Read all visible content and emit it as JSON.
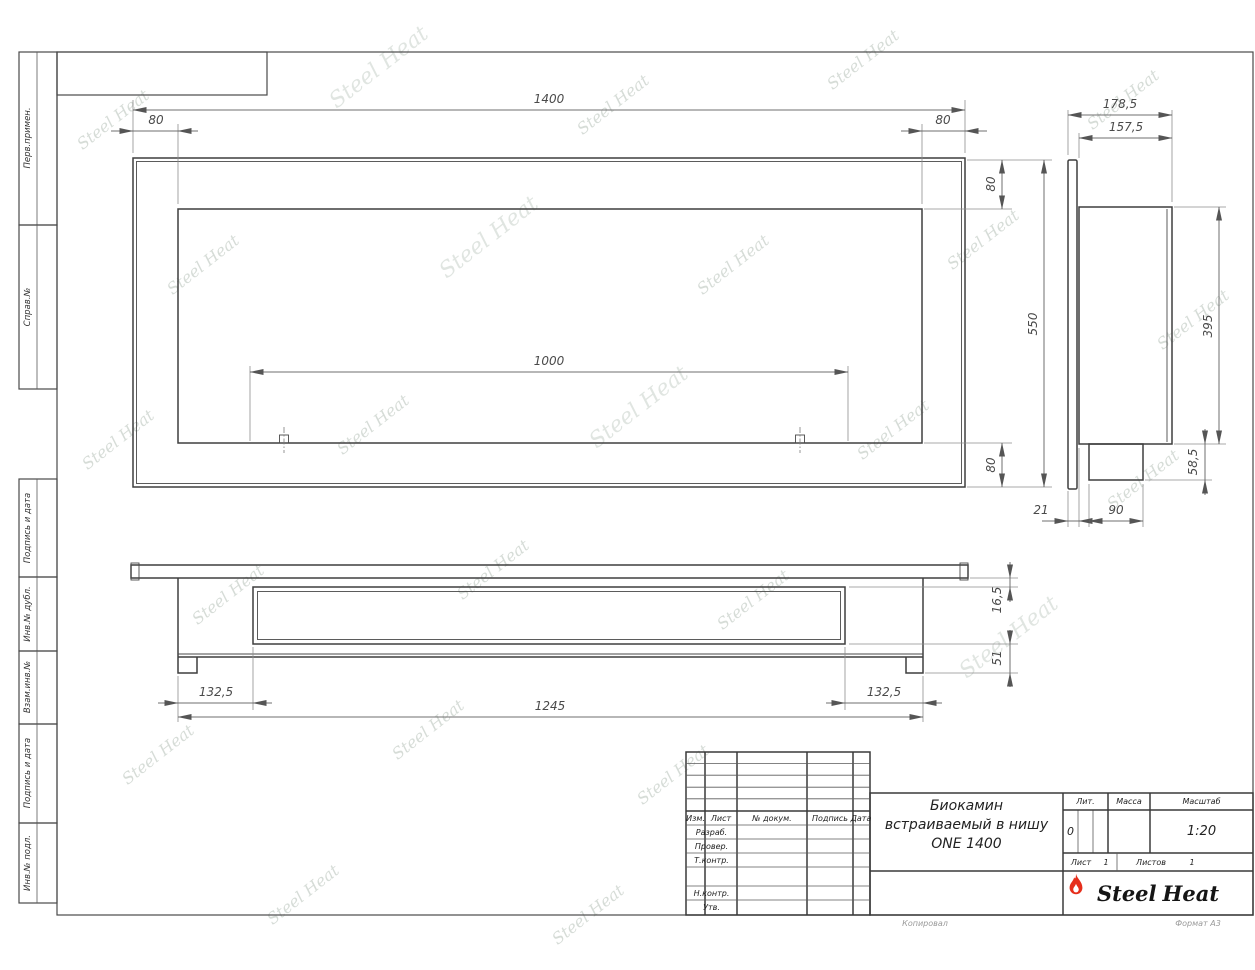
{
  "watermark": {
    "text": "Steel Heat"
  },
  "sidebar": {
    "items": [
      "Перв.примен.",
      "Справ.№",
      "Подпись и дата",
      "Инв.№ дубл.",
      "Взам.инв.№",
      "Подпись и дата",
      "Инв.№ подл."
    ]
  },
  "views": {
    "front": {
      "width": "1400",
      "margin_left": "80",
      "margin_right": "80",
      "margin_top": "80",
      "height": "550",
      "margin_bottom": "80",
      "burner_length": "1000"
    },
    "side": {
      "depth_total": "178,5",
      "depth_body": "157,5",
      "body_height": "395",
      "box_height": "58,5",
      "flange_thickness": "21",
      "box_width": "90"
    },
    "plan": {
      "flange_gap": "16,5",
      "box_depth": "51",
      "inset_left": "132,5",
      "body_width": "1245",
      "inset_right": "132,5"
    }
  },
  "title_block": {
    "header": {
      "izm": "Изм.",
      "list": "Лист",
      "doc": "№ докум.",
      "sign": "Подпись",
      "date": "Дата"
    },
    "roles": {
      "developed": "Разраб.",
      "checked": "Провер.",
      "tcontrol": "Т.контр.",
      "ncontrol": "Н.контр.",
      "approved": "Утв."
    },
    "title_line1": "Биокамин",
    "title_line2": "встраиваемый в нишу",
    "title_line3": "ONE 1400",
    "lit_label": "Лит.",
    "mass_label": "Масса",
    "scale_label": "Масштаб",
    "lit_value": "0",
    "scale_value": "1:20",
    "sheet_label": "Лист",
    "sheet_value": "1",
    "sheets_label": "Листов",
    "sheets_value": "1",
    "logo_steel": "Steel",
    "logo_heat": "Heat",
    "footer_copy": "Копировал",
    "footer_format": "Формат A3"
  }
}
